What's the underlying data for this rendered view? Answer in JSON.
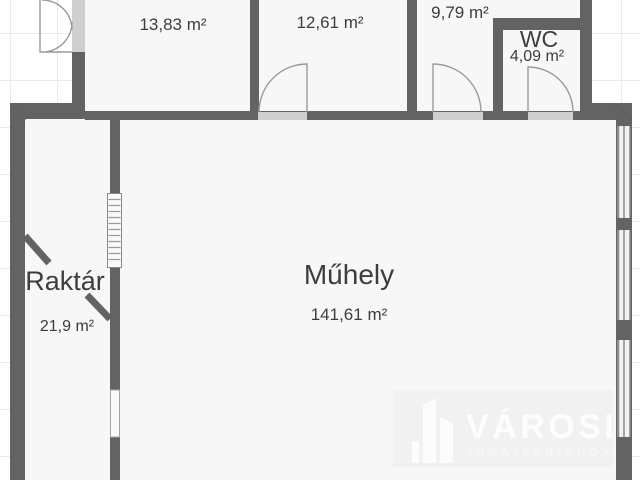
{
  "rooms": [
    {
      "area": "13,83 m²"
    },
    {
      "area": "12,61 m²"
    },
    {
      "area": "9,79 m²"
    },
    {
      "name": "WC",
      "area": "4,09 m²"
    },
    {
      "name": "Raktár",
      "area": "21,9 m²"
    },
    {
      "name": "Műhely",
      "area": "141,61 m²"
    }
  ],
  "watermark": {
    "brand": "VÁROSI",
    "subtitle": "INGATLANIRODA"
  },
  "colors": {
    "wall": "#636363",
    "floor": "#f7f7f7",
    "threshold": "#cfcfcf",
    "grid": "#ebebeb",
    "door_arc": "#9a9a9a",
    "label_text": "#3d3d3d",
    "watermark_text": "#ffffff"
  }
}
